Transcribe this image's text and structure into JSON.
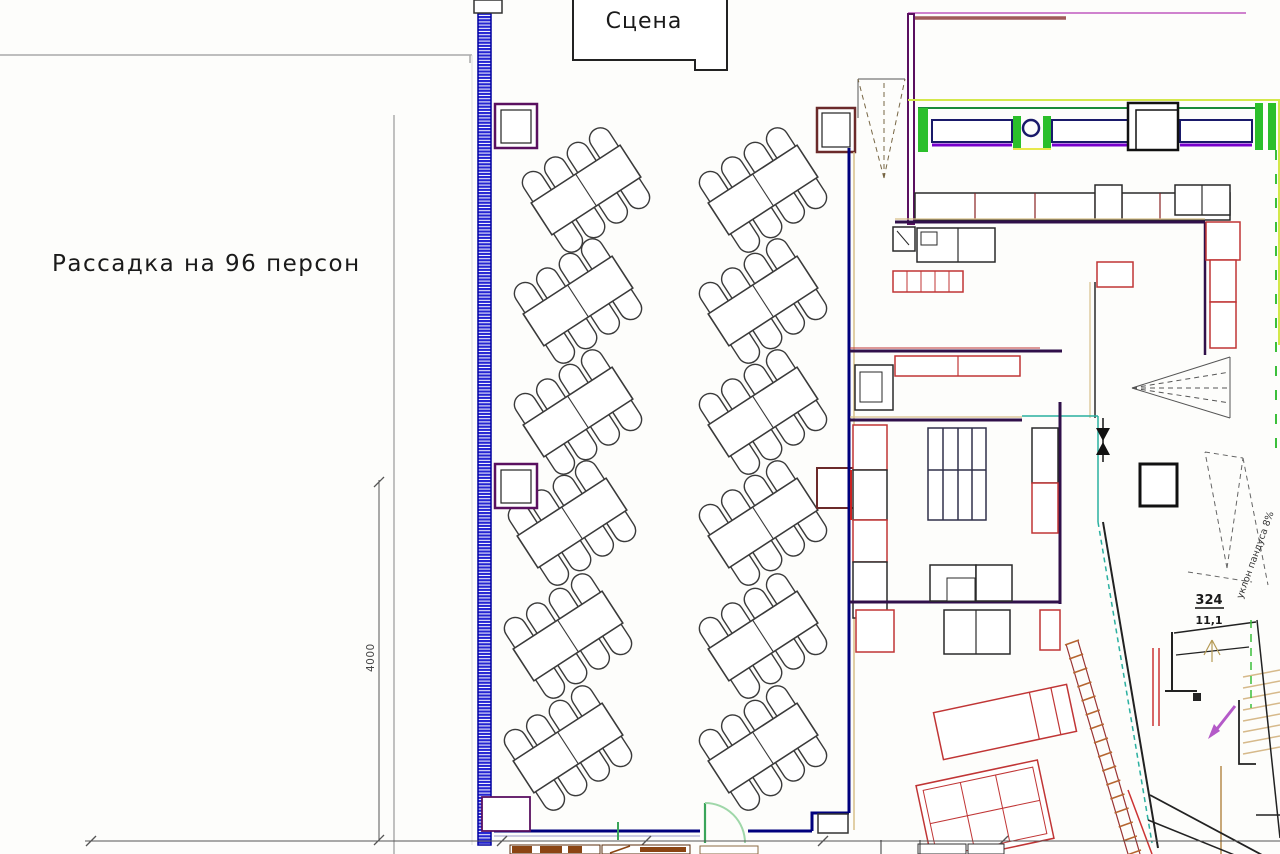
{
  "drawing": {
    "seating_title": "Рассадка на 96 персон",
    "stage_label": "Сцена",
    "vertical_dimension": "4000",
    "room_number": "324",
    "room_area": "11,1",
    "ramp_note": "уклон пандуса 8%"
  },
  "colors": {
    "wall_hatch_blue": "#2525d2",
    "wall_navy": "#00007d",
    "wall_purple": "#5a1060",
    "counter_green": "#2bbf2b",
    "lime_edge": "#d4e84a",
    "equipment_red": "#c03535",
    "equipment_outline": "#2a2a2a",
    "furniture_brown": "#8b4513",
    "door_green": "#3aa55a",
    "teal_guide": "#2ab0a0",
    "direction_arrow_magenta": "#b45ac8",
    "tread_tan": "#d6b98a"
  },
  "floor_plan": {
    "tables_total": 12,
    "seats_per_table": 8,
    "table_size": {
      "length": 106,
      "width": 38
    },
    "tables": [
      {
        "x": 586,
        "y": 190,
        "angle": -33
      },
      {
        "x": 578,
        "y": 301,
        "angle": -33
      },
      {
        "x": 578,
        "y": 412,
        "angle": -33
      },
      {
        "x": 572,
        "y": 523,
        "angle": -33
      },
      {
        "x": 568,
        "y": 636,
        "angle": -33
      },
      {
        "x": 568,
        "y": 748,
        "angle": -33
      },
      {
        "x": 763,
        "y": 190,
        "angle": -33
      },
      {
        "x": 763,
        "y": 301,
        "angle": -33
      },
      {
        "x": 763,
        "y": 412,
        "angle": -33
      },
      {
        "x": 763,
        "y": 523,
        "angle": -33
      },
      {
        "x": 763,
        "y": 636,
        "angle": -33
      },
      {
        "x": 763,
        "y": 748,
        "angle": -33
      }
    ],
    "stairs": {
      "tread_count": 8
    },
    "wall_band_hatch_ticks": 16
  }
}
